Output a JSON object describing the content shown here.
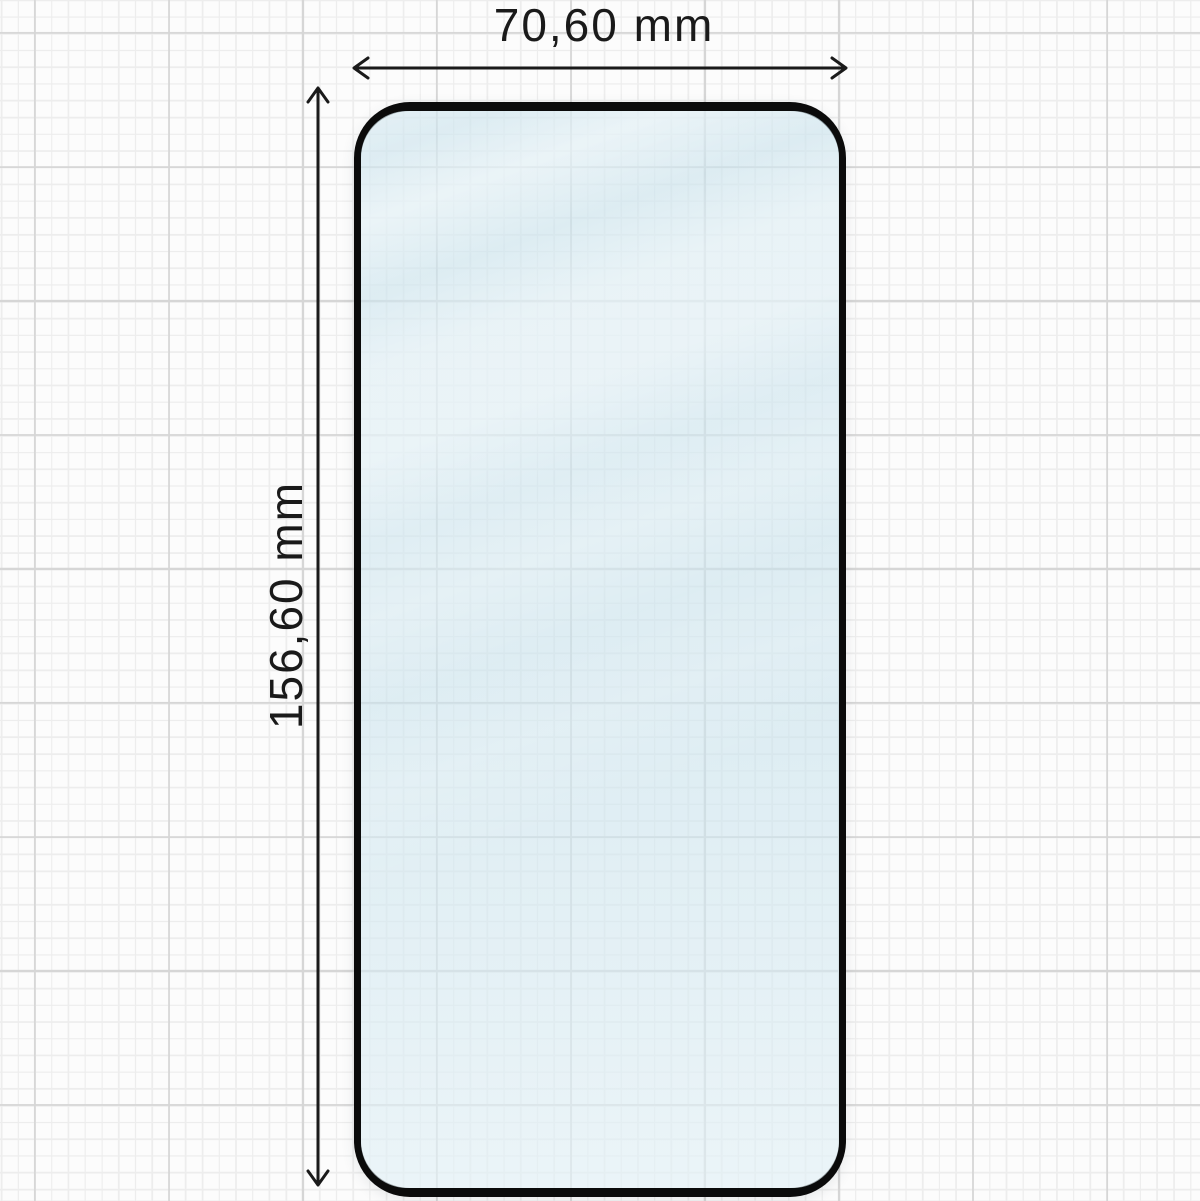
{
  "dimensions": {
    "width_label": "70,60 mm",
    "height_label": "156,60 mm"
  },
  "icons": {
    "arrow_left": "←",
    "arrow_right": "→",
    "arrow_up": "↑",
    "arrow_down": "↓"
  },
  "colors": {
    "paper": "#fcfcfc",
    "grid_minor": "#ededed",
    "grid_major": "#d6d6d6",
    "ink": "#1a1a1a",
    "frame": "#0b0b0b",
    "glass_tint": "#d0e7f0",
    "glass_highlight": "#ffffff"
  }
}
